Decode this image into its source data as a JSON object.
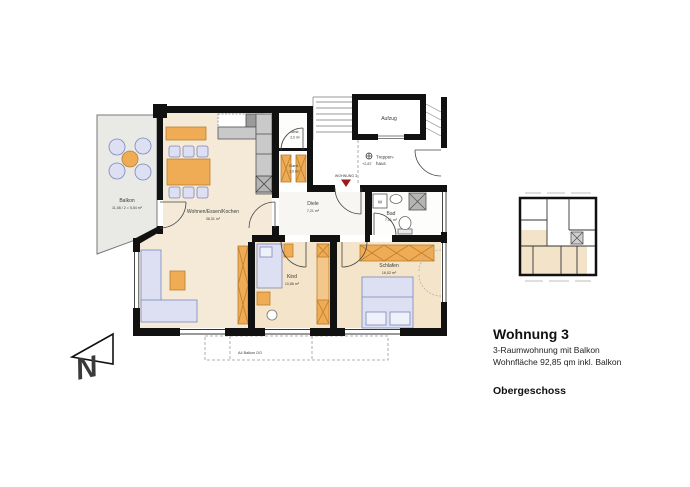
{
  "legend": {
    "title": "Wohnung 3",
    "subtitle1": "3-Raumwohnung mit Balkon",
    "subtitle2": "Wohnfläche 92,85 qm inkl. Balkon",
    "floor": "Obergeschoss"
  },
  "rooms": {
    "balkon": {
      "name": "Balkon",
      "area": "11,08 / 2 = 5,54 m²"
    },
    "wohnen": {
      "name": "Wohnen/Essen/Kochen",
      "area": "38,31 m²"
    },
    "abst": {
      "name": "Abst.",
      "area": "2,0 m²"
    },
    "gard": {
      "name": "Gard.",
      "area": "2,0 m²"
    },
    "diele": {
      "name": "Diele",
      "area": "7,21 m²"
    },
    "bad": {
      "name": "Bad",
      "area": "7,01 m²"
    },
    "kind": {
      "name": "Kind",
      "area": "10,86 m²"
    },
    "schlafen": {
      "name": "Schlafen",
      "area": "16,02 m²"
    }
  },
  "common": {
    "aufzug": "Aufzug",
    "treppenhaus_line1": "Treppen-",
    "treppenhaus_line2": "haus",
    "level": "+2,87",
    "entrance_marker": "WOHNUNG 3",
    "washing_machine": "W"
  },
  "annotations": {
    "balkon_dg": "A4 Balkon DG",
    "north": "N"
  },
  "colors": {
    "wall": "#111111",
    "room_fill": "#f4e7d2",
    "furniture_orange": "#f0ab55",
    "furniture_blue": "#dce0f2",
    "balcony_gray": "#e9e9e6",
    "marker_red": "#9e1b1b"
  }
}
